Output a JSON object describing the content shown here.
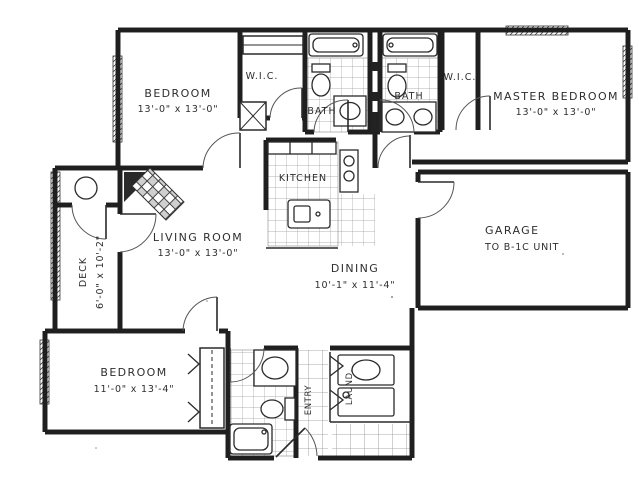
{
  "plan": {
    "type": "apartment-floor-plan",
    "colors": {
      "ink": "#1f1f1f",
      "paper": "#ffffff",
      "tile": "#9a9a9a"
    },
    "rooms": {
      "bedroom_top": {
        "label": "BEDROOM",
        "dims": "13'-0\" x 13'-0\""
      },
      "wic_left": {
        "label": "W.I.C."
      },
      "bath_left": {
        "label": "BATH"
      },
      "bath_right": {
        "label": "BATH"
      },
      "wic_right": {
        "label": "W.I.C."
      },
      "master_bedroom": {
        "label": "MASTER BEDROOM",
        "dims": "13'-0\" x 13'-0\""
      },
      "kitchen": {
        "label": "KITCHEN"
      },
      "living_room": {
        "label": "LIVING ROOM",
        "dims": "13'-0\" x 13'-0\""
      },
      "dining": {
        "label": "DINING",
        "dims": "10'-1\" x 11'-4\""
      },
      "garage": {
        "label": "GARAGE",
        "dims": "TO B-1C UNIT"
      },
      "deck": {
        "label": "DECK",
        "dims": "6'-0\" x 10'-2\""
      },
      "bedroom_lower": {
        "label": "BEDROOM",
        "dims": "11'-0\" x 13'-4\""
      },
      "entry": {
        "label": "ENTRY"
      },
      "laundry": {
        "label": "LAUND."
      }
    },
    "fixtures": [
      "bathtub",
      "toilet",
      "sink",
      "double-vanity",
      "kitchen-island-sink",
      "cooktop",
      "refrigerator-counter",
      "washer-dryer",
      "fireplace",
      "closet-shelf",
      "deck-table",
      "bifold-doors",
      "windows"
    ]
  }
}
